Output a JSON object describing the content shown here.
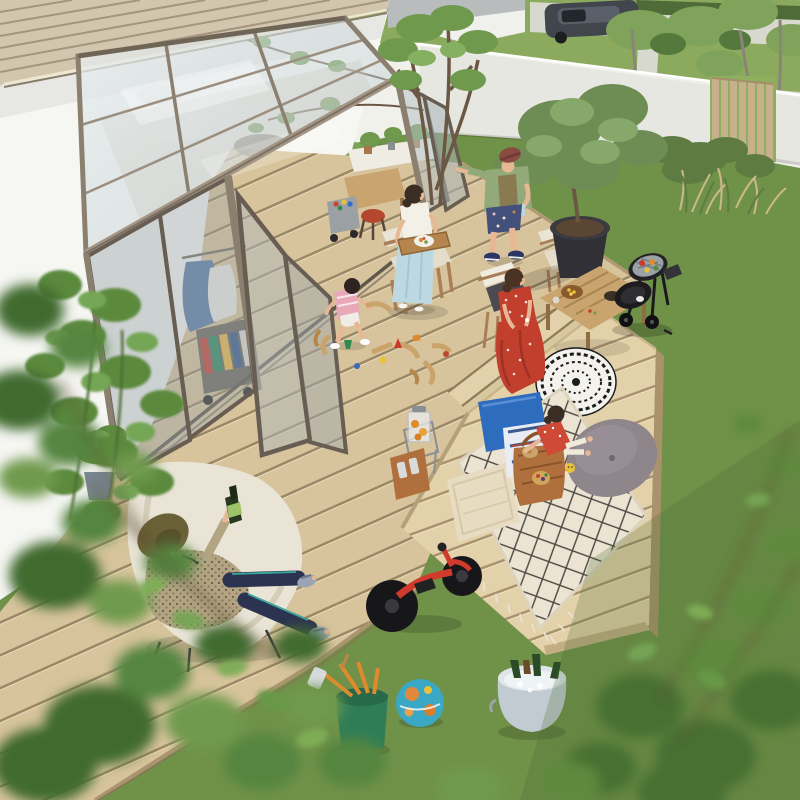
{
  "image": {
    "kind": "photograph",
    "view": "elevated three-quarter aerial view",
    "setting": "Suburban backyard with a glass-roofed garden sunroom attached to a white house, composite wood deck, lawn, and a family barbecue picnic gathering"
  },
  "palette": {
    "grass": "#7fa050",
    "grass_shade": "#5f7f3c",
    "lawn_far": "#a9c46e",
    "deck": "#d8c49c",
    "deck_gap": "#9c8766",
    "deck_light": "#e3d1a9",
    "deck_fascia": "#b39a72",
    "wall_house": "#f6f6f3",
    "wall_boundary": "#f1f1ec",
    "louver": "#d3c6ae",
    "frame": "#8b7f6f",
    "frame_dark": "#675d52",
    "glass": "#c4d0d5",
    "fence": "#c7b08c",
    "pavement": "#dbdad4",
    "car": "#41464d",
    "bbq": "#222226",
    "pot": "#303036",
    "trunk": "#6b5844",
    "foliage_dark": "#466f30",
    "foliage": "#5f8a3e",
    "foliage_light": "#74a655",
    "rug": "#ece4d2",
    "rug_line": "#4a4742",
    "pillow_blue": "#2e6cbe",
    "pillow_cream": "#e7dcc2",
    "cushion_gray": "#8e868a",
    "basket": "#b0703e",
    "bike_red": "#d03a2c",
    "ball_teal": "#3aa8c4",
    "bucket_green": "#2f7d57",
    "tub_metal": "#c2cbd1",
    "parasol_white": "#f4f2ec",
    "parasol_black": "#1d1d1f",
    "skin": "#e8b894",
    "dress_red": "#c23f2e",
    "pants_blue": "#bcd9e2",
    "shirt_green": "#92a97a",
    "cap_maroon": "#8a4a40",
    "hat_olive": "#6b6136",
    "pants_navy": "#2c3350",
    "shirt_beige": "#b3a584",
    "hair_dark": "#3a2d24",
    "chair_canvas": "#e9e4d6",
    "wood_mid": "#c9a46f",
    "juice_orange": "#e08a28"
  },
  "scene": {
    "people": [
      {
        "id": "man-reclining",
        "pose": "reclining in a butterfly chair holding a beer bottle",
        "clothing": "olive bucket hat, patterned beige shirt, navy pants with teal trim, gray sandals"
      },
      {
        "id": "woman-tray",
        "pose": "stepping out of the folding doors carrying a wooden tray with a plate of food",
        "clothing": "white top, light blue wide-leg pants, sandals"
      },
      {
        "id": "man-cap",
        "pose": "standing against the open folding door holding a drink",
        "clothing": "maroon flat cap, sage green open shirt, dark floral shorts, navy sneakers"
      },
      {
        "id": "toddler-playing",
        "pose": "sitting on the deck playing with a wooden train track",
        "clothing": "pink striped top, white shoes"
      },
      {
        "id": "woman-red-dress",
        "pose": "seated on a folding chair beside a low snack table",
        "clothing": "red floral maxi dress, white bracelet"
      },
      {
        "id": "girl-picnic",
        "pose": "lying on the picnic rug reaching toward the picnic basket",
        "clothing": "red patterned top, light shorts"
      }
    ],
    "objects": [
      "glass-roof-sunroom",
      "folding-glass-doors",
      "louver-awning",
      "white-house-wall",
      "boundary-wall",
      "slat-fence",
      "neighbor-yard-paving",
      "parked-car",
      "wood-deck",
      "deck-steps",
      "lower-deck-platform",
      "picnic-rug",
      "picnic-basket",
      "blue-pillow",
      "cream-pillow",
      "gray-floor-cushion",
      "patterned-parasol",
      "kettle-bbq-grill",
      "potted-olive-tree",
      "director-chairs",
      "low-snack-table",
      "drink-dispenser-stand",
      "balance-bike",
      "globe-ball",
      "garden-tool-bucket",
      "ice-bottle-tub",
      "wooden-train-toys",
      "magazine-cart",
      "hanging-laundry",
      "interior-shelf-plants",
      "red-stool",
      "butterfly-chair",
      "foreground-foliage"
    ]
  }
}
